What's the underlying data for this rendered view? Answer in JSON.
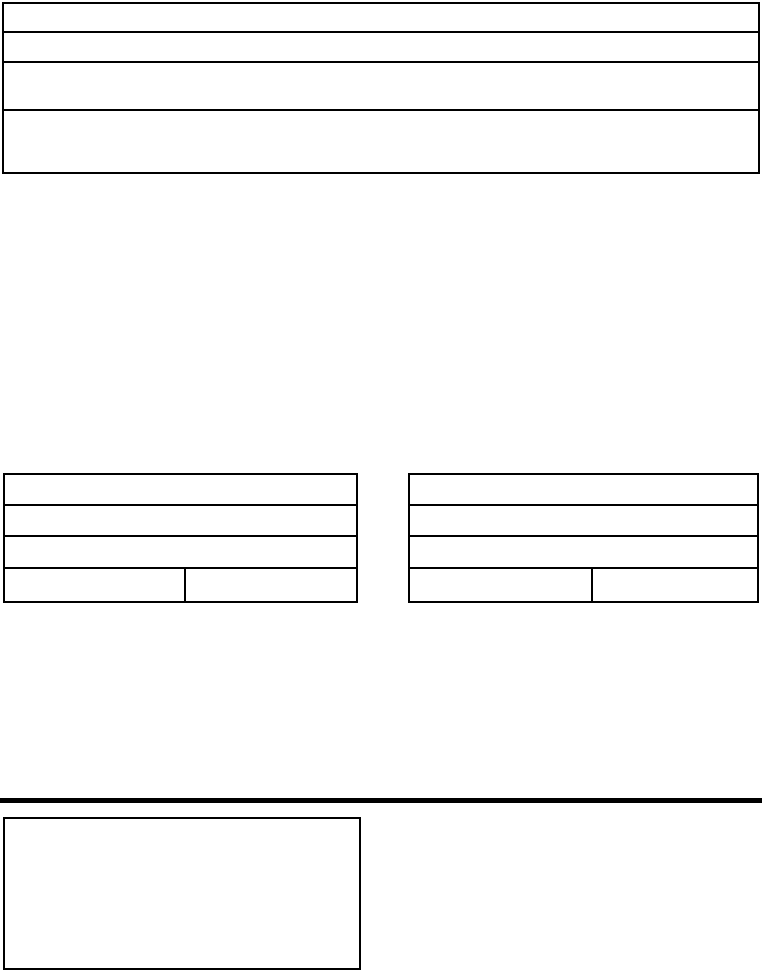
{
  "page": {
    "background_color": "#ffffff",
    "line_color": "#000000"
  },
  "header_table": {
    "rows": [
      {
        "text": ""
      },
      {
        "text": ""
      },
      {
        "text": ""
      },
      {
        "text": ""
      }
    ]
  },
  "left_table": {
    "rows": [
      {
        "text": ""
      },
      {
        "text": ""
      },
      {
        "text": ""
      }
    ],
    "split_row": {
      "left_cell": {
        "text": ""
      },
      "right_cell": {
        "text": ""
      }
    }
  },
  "right_table": {
    "rows": [
      {
        "text": ""
      },
      {
        "text": ""
      },
      {
        "text": ""
      }
    ],
    "split_row": {
      "left_cell": {
        "text": ""
      },
      "right_cell": {
        "text": ""
      }
    }
  },
  "footer_box": {
    "text": ""
  }
}
